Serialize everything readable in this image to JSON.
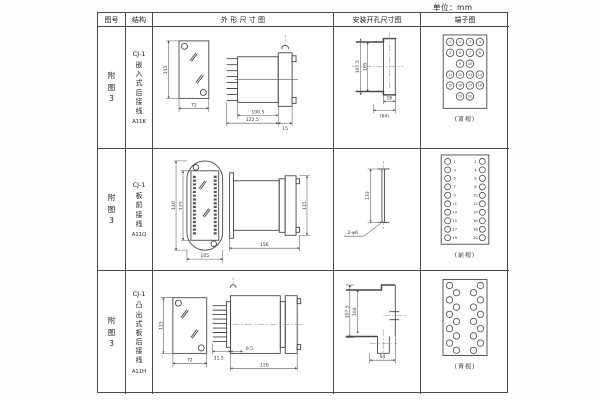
{
  "page": {
    "unit": "单位：mm"
  },
  "headers": {
    "figure": "图号",
    "structure": "结构",
    "outline": "外 形 尺 寸 图",
    "mounting": "安装开孔尺寸图",
    "terminal": "端子图"
  },
  "rows": [
    {
      "figure_no": "附图3",
      "structure": {
        "model": "CJ-1",
        "type": "嵌入式后接线",
        "code": "A11K"
      },
      "outline": {
        "front": {
          "h": "115",
          "w": "72"
        },
        "side": {
          "d1": "100.5",
          "d2": "122.5",
          "d3": "15"
        }
      },
      "mounting": {
        "v1": "107.5",
        "v2": "105",
        "h1": "16",
        "h2": "(64)"
      },
      "terminal": {
        "label": "(背视)",
        "numbers": [
          "1",
          "2",
          "3",
          "4",
          "5",
          "6",
          "7",
          "8",
          "9",
          "10",
          "11",
          "12",
          "13",
          "14",
          "15",
          "16",
          "17",
          "18",
          "19",
          "20"
        ]
      }
    },
    {
      "figure_no": "附图3",
      "structure": {
        "model": "CJ-1",
        "type": "板前接线",
        "code": "A11Q"
      },
      "outline": {
        "front": {
          "h1": "140",
          "h2": "125",
          "w": "105"
        },
        "side": {
          "w": "156",
          "h": "115"
        }
      },
      "mounting": {
        "v": "133",
        "hole": "2-φ6"
      },
      "terminal": {
        "label": "(前视)",
        "left": [
          "1",
          "3",
          "5",
          "7",
          "9",
          "11",
          "13",
          "15",
          "17",
          "19"
        ],
        "right": [
          "2",
          "4",
          "6",
          "8",
          "10",
          "12",
          "14",
          "16",
          "18",
          "20"
        ]
      }
    },
    {
      "figure_no": "附图3",
      "structure": {
        "model": "CJ-1",
        "type": "凸出式板后接线",
        "code": "A11H"
      },
      "outline": {
        "front": {
          "h": "115",
          "w": "72"
        },
        "side": {
          "d1": "31.5",
          "d2": "9.5",
          "d3": "126"
        }
      },
      "mounting": {
        "v1": "107.5",
        "v2": "104",
        "h1": "64"
      },
      "terminal": {
        "label": "(背视)"
      }
    }
  ]
}
